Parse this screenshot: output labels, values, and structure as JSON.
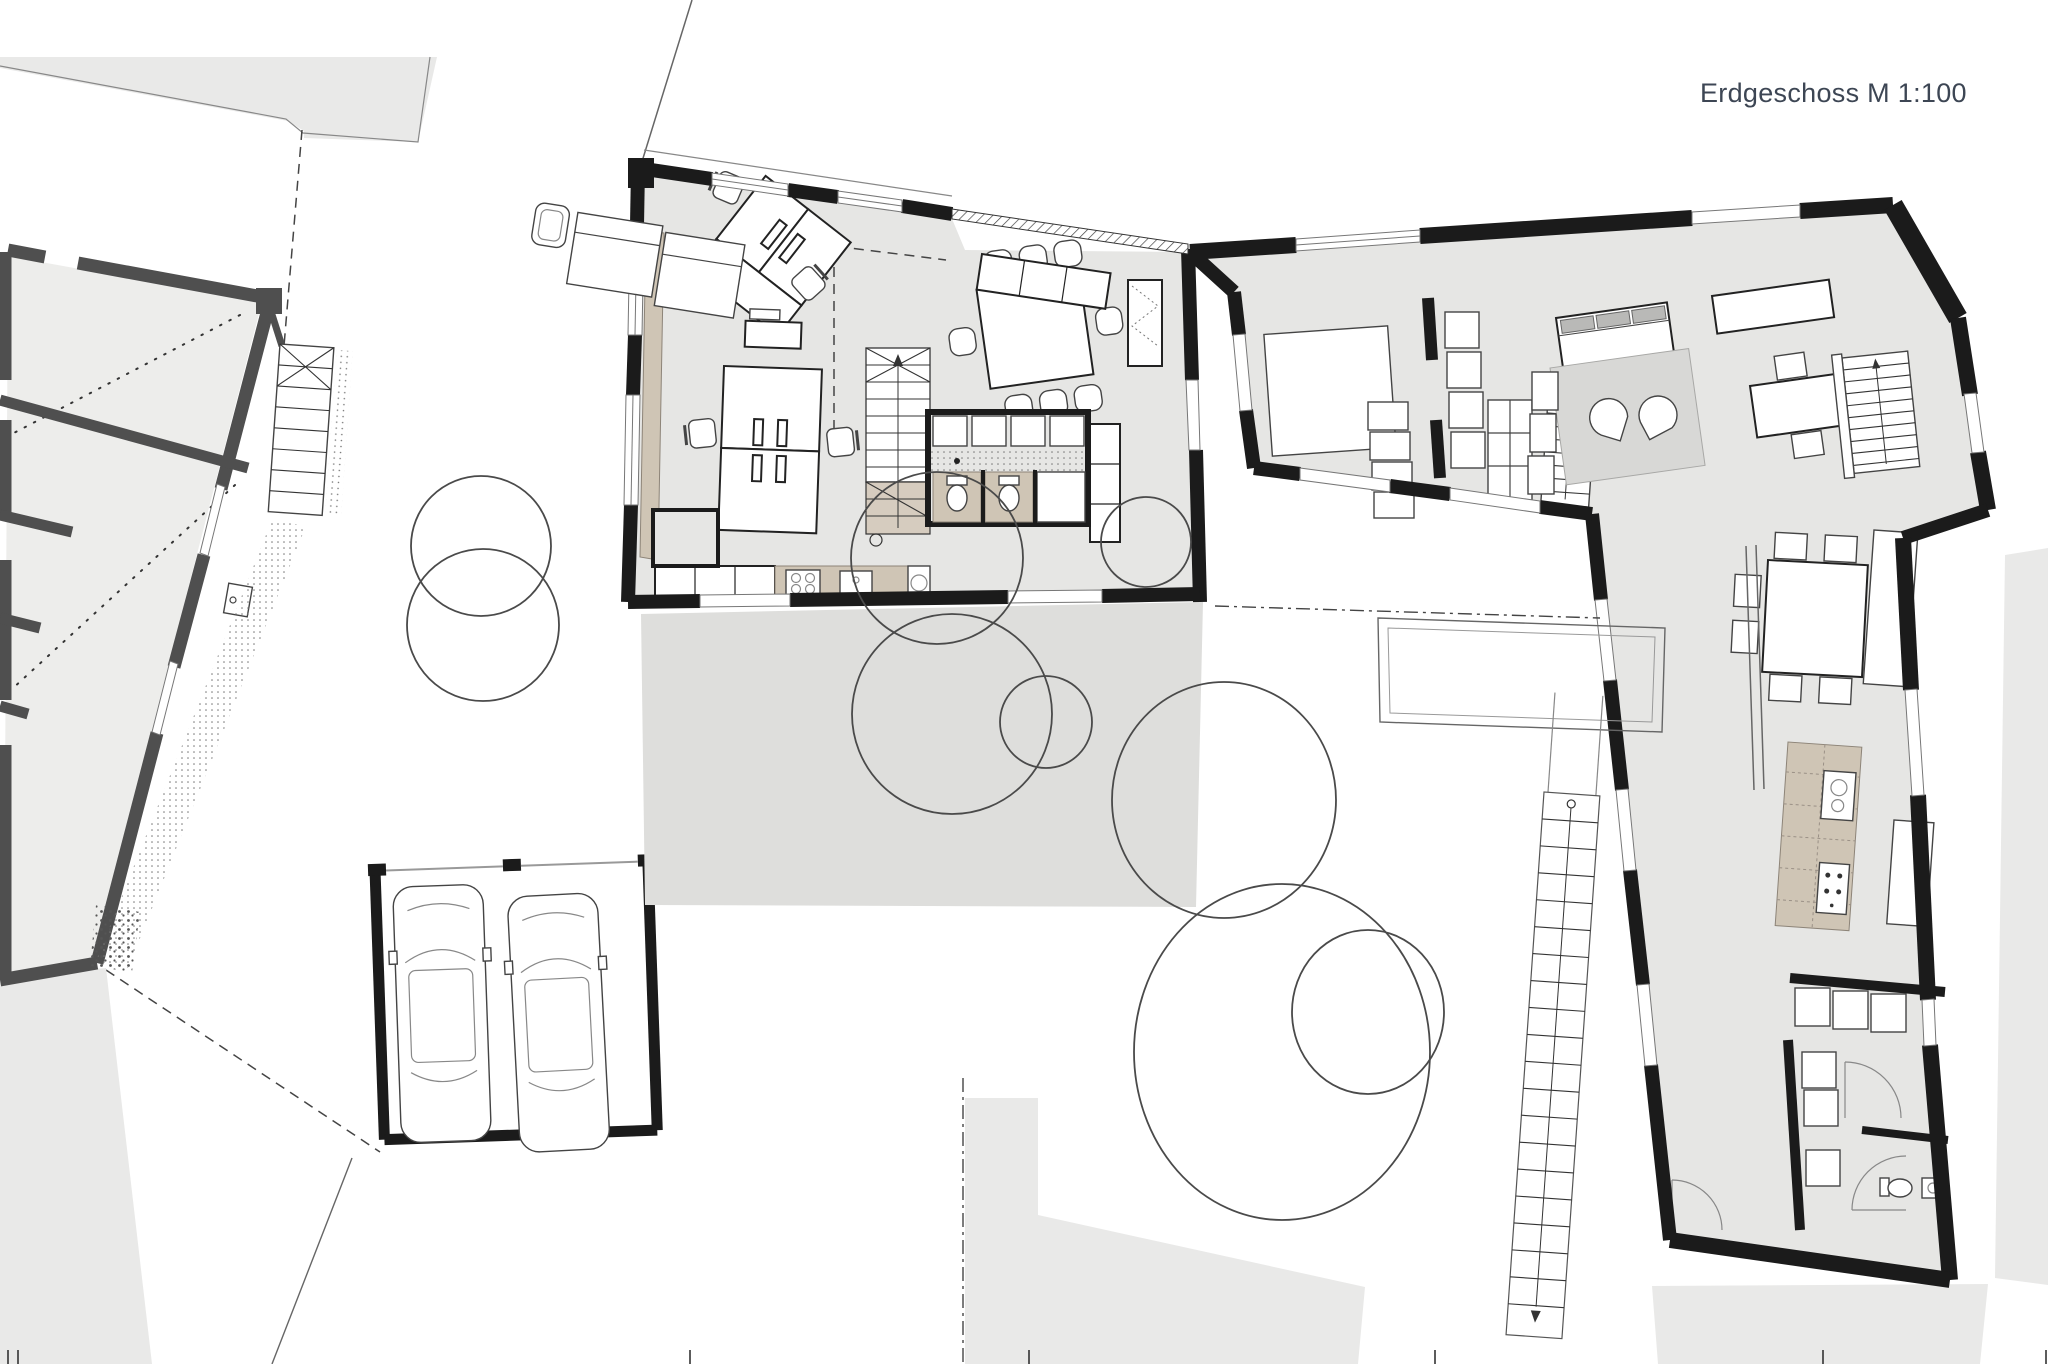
{
  "title": {
    "label": "Erdgeschoss M 1:100"
  },
  "plan": {
    "colors": {
      "wall_black": "#1b1b1b",
      "wall_gray": "#4f4f4f",
      "floor_light": "#e6e6e4",
      "floor_left": "#ededeb",
      "site_gray": "#e9e9e8",
      "terrace_gray": "#dededc",
      "wood_beige": "#cfc5b5",
      "stair_beige": "#d6ccbf",
      "rug_gray": "#d8d8d6",
      "cushion_gray": "#b9b9b7",
      "line_gray": "#666666",
      "title_color": "#3d4654"
    },
    "trees": [
      {
        "cx": 481,
        "cy": 546,
        "rx": 70,
        "ry": 70
      },
      {
        "cx": 483,
        "cy": 625,
        "rx": 76,
        "ry": 76
      },
      {
        "cx": 937,
        "cy": 558,
        "rx": 86,
        "ry": 86
      },
      {
        "cx": 952,
        "cy": 714,
        "rx": 100,
        "ry": 100
      },
      {
        "cx": 1046,
        "cy": 722,
        "rx": 46,
        "ry": 46
      },
      {
        "cx": 1146,
        "cy": 542,
        "rx": 45,
        "ry": 45
      },
      {
        "cx": 1224,
        "cy": 800,
        "rx": 112,
        "ry": 118
      },
      {
        "cx": 1282,
        "cy": 1052,
        "rx": 148,
        "ry": 168
      },
      {
        "cx": 1368,
        "cy": 1012,
        "rx": 76,
        "ry": 82
      }
    ],
    "scale_ticks_x": [
      8,
      18,
      690,
      1029,
      1435,
      1823,
      2046
    ],
    "scale_tick_y1": 1350,
    "scale_tick_y2": 1364
  }
}
